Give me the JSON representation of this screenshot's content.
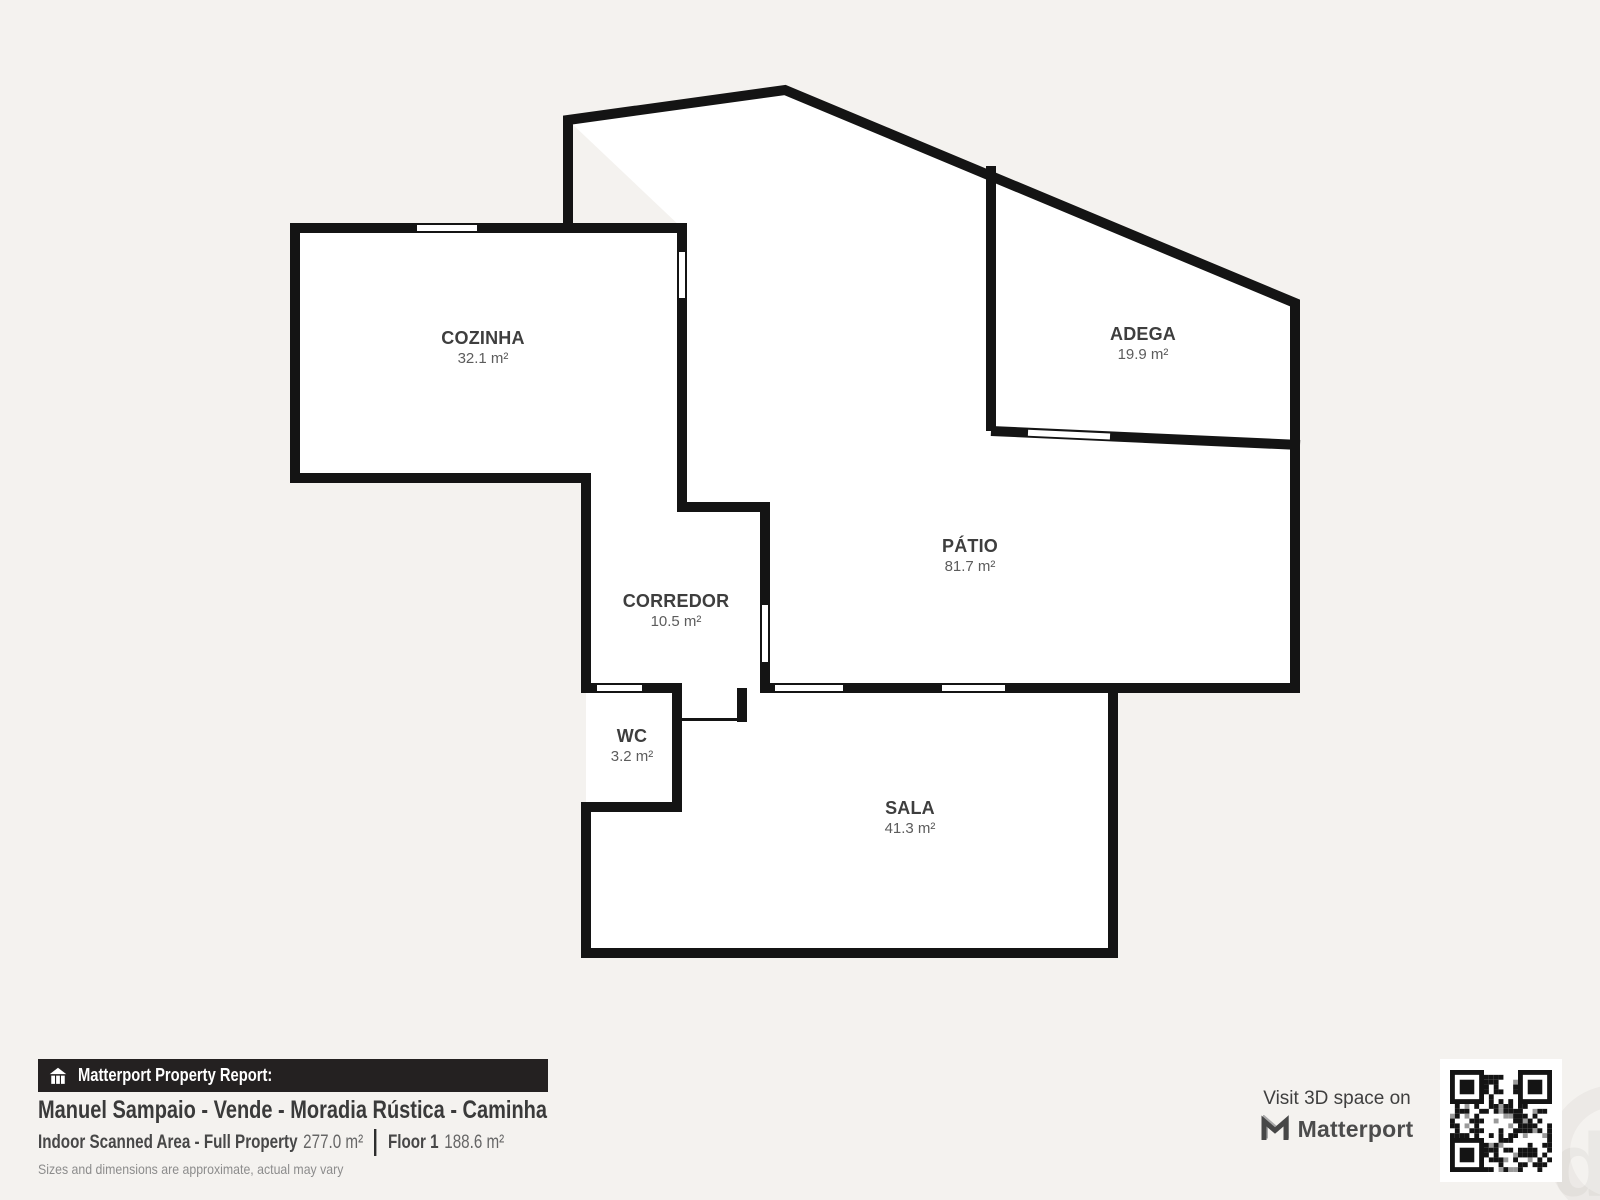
{
  "colors": {
    "background": "#f4f2ef",
    "wall": "#141414",
    "room_fill": "#ffffff",
    "room_name_text": "#3e3e3e",
    "room_area_text": "#5c5c5c",
    "report_bar_bg": "#242121",
    "report_bar_text": "#ffffff",
    "title_text": "#3a3a3a",
    "disclaimer_text": "#8c8c8c",
    "qr_bg": "#ffffff"
  },
  "floorplan": {
    "rooms": [
      {
        "id": "cozinha",
        "name": "COZINHA",
        "area": "32.1 m²"
      },
      {
        "id": "adega",
        "name": "ADEGA",
        "area": "19.9 m²"
      },
      {
        "id": "patio",
        "name": "PÁTIO",
        "area": "81.7 m²"
      },
      {
        "id": "corredor",
        "name": "CORREDOR",
        "area": "10.5 m²"
      },
      {
        "id": "wc",
        "name": "WC",
        "area": "3.2 m²"
      },
      {
        "id": "sala",
        "name": "SALA",
        "area": "41.3 m²"
      }
    ]
  },
  "report": {
    "bar_icon": "house-icon",
    "bar_label": "Matterport Property Report:",
    "title": "Manuel Sampaio - Vende - Moradia Rústica - Caminha",
    "indoor_label": "Indoor Scanned Area - Full Property",
    "indoor_value": "277.0 m²",
    "floor_label": "Floor 1",
    "floor_value": "188.6 m²",
    "disclaimer": "Sizes and dimensions are approximate, actual may vary"
  },
  "cta": {
    "visit_text": "Visit 3D space on",
    "logo_icon": "matterport-logo-icon",
    "logo_text": "Matterport",
    "qr_icon": "qr-code"
  }
}
